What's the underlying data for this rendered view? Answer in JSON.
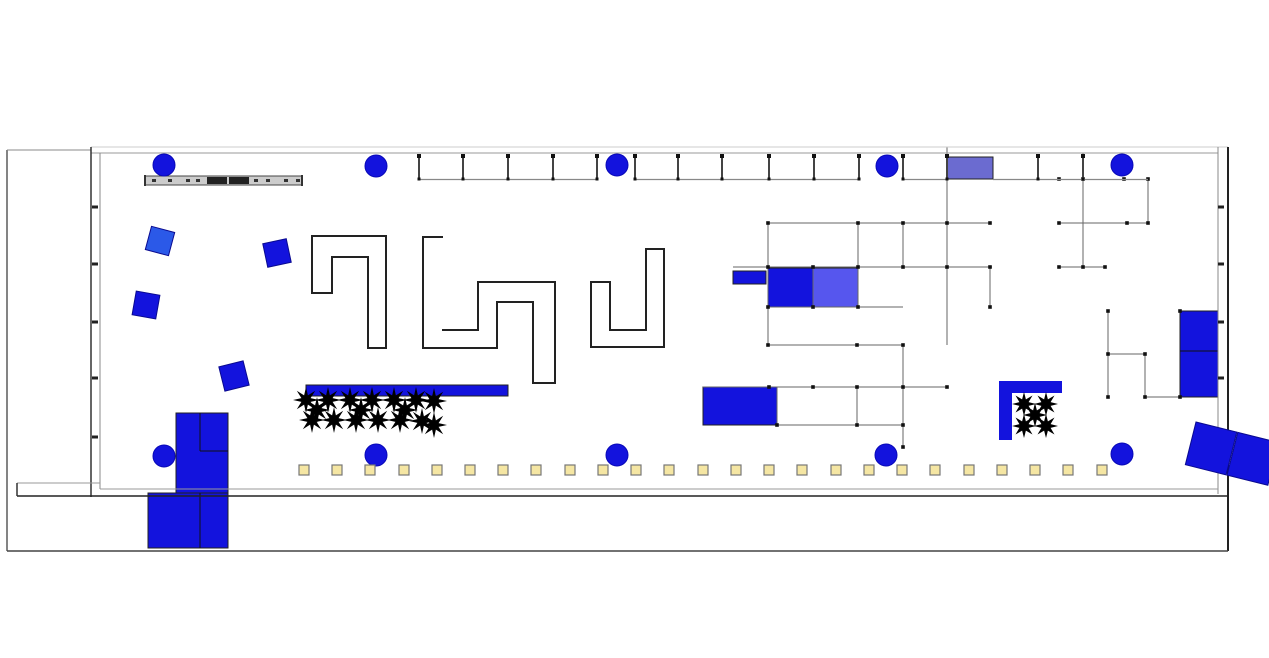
{
  "app": {
    "width": 1269,
    "height": 658,
    "background": "#ffffff",
    "description": "CAD exhibition-hall floor plan"
  },
  "palette": {
    "blue": "#1313dd",
    "blue_light": "#5656ee",
    "purple": "#6b6bd0",
    "blue_alt": "#2b59e8",
    "yellow_fill": "#f5e6a3",
    "yellow_stroke": "#777777",
    "wall_dark": "#222222",
    "wall_mid": "#666666",
    "wall_light": "#999999",
    "gray_bar_fill": "#cccccc",
    "plant": "#000000",
    "node": "#111111"
  },
  "columns": {
    "radius": 11,
    "positions": [
      [
        164,
        165
      ],
      [
        376,
        166
      ],
      [
        617,
        165
      ],
      [
        887,
        166
      ],
      [
        1122,
        165
      ],
      [
        164,
        456
      ],
      [
        376,
        455
      ],
      [
        617,
        455
      ],
      [
        886,
        455
      ],
      [
        1122,
        454
      ]
    ]
  },
  "rotated_squares": [
    {
      "cx": 160,
      "cy": 241,
      "size": 24,
      "angle": 15,
      "color": "#2b59e8"
    },
    {
      "cx": 277,
      "cy": 253,
      "size": 24,
      "angle": -12,
      "color": "#1313dd"
    },
    {
      "cx": 146,
      "cy": 305,
      "size": 24,
      "angle": 10,
      "color": "#1313dd"
    },
    {
      "cx": 234,
      "cy": 376,
      "size": 25,
      "angle": -14,
      "color": "#1313dd"
    }
  ],
  "booths": [
    {
      "x": 306,
      "y": 385,
      "w": 202,
      "h": 11,
      "fill": "#1313dd",
      "name": "platform-bar"
    },
    {
      "x": 733,
      "y": 271,
      "w": 33,
      "h": 13,
      "fill": "#1313dd",
      "name": "booth-small-bar"
    },
    {
      "x": 768,
      "y": 268,
      "w": 45,
      "h": 39,
      "fill": "#1313dd",
      "name": "booth-dark-blue"
    },
    {
      "x": 813,
      "y": 268,
      "w": 45,
      "h": 39,
      "fill": "#5656ee",
      "name": "booth-light-blue"
    },
    {
      "x": 947,
      "y": 157,
      "w": 46,
      "h": 22,
      "fill": "#6b6bd0",
      "name": "booth-purple"
    },
    {
      "x": 703,
      "y": 387,
      "w": 74,
      "h": 38,
      "fill": "#1313dd",
      "name": "booth-lower-blue"
    },
    {
      "x": 1180,
      "y": 311,
      "w": 38,
      "h": 86,
      "fill": "#1313dd",
      "name": "booth-right-double"
    },
    {
      "x": 176,
      "y": 413,
      "w": 52,
      "h": 80,
      "fill": "#1313dd",
      "name": "entrance-block-upper"
    },
    {
      "x": 148,
      "y": 493,
      "w": 80,
      "h": 55,
      "fill": "#1313dd",
      "name": "entrance-block-lower"
    }
  ],
  "booth_inner_lines": [
    [
      200,
      413,
      200,
      451
    ],
    [
      200,
      451,
      228,
      451
    ],
    [
      200,
      493,
      200,
      548
    ],
    [
      1180,
      351,
      1218,
      351
    ]
  ],
  "tilted_pair": {
    "tx": 1196,
    "ty": 422,
    "angle": 14,
    "rects": [
      [
        0,
        0,
        42,
        44
      ],
      [
        43,
        0,
        42,
        44
      ]
    ],
    "fill": "#1313dd"
  },
  "planter": {
    "bars": [
      [
        999,
        381,
        13,
        59
      ],
      [
        999,
        381,
        63,
        12
      ]
    ],
    "fill": "#1313dd"
  },
  "plants": {
    "r_outer": 13,
    "r_inner": 5,
    "small": [
      [
        1024,
        404
      ],
      [
        1046,
        404
      ],
      [
        1024,
        426
      ],
      [
        1046,
        426
      ],
      [
        1035,
        415
      ]
    ],
    "large": [
      [
        306,
        400
      ],
      [
        328,
        400
      ],
      [
        350,
        400
      ],
      [
        372,
        400
      ],
      [
        394,
        400
      ],
      [
        416,
        400
      ],
      [
        434,
        401
      ],
      [
        312,
        420
      ],
      [
        334,
        420
      ],
      [
        356,
        420
      ],
      [
        378,
        420
      ],
      [
        400,
        420
      ],
      [
        422,
        421
      ],
      [
        317,
        410
      ],
      [
        361,
        410
      ],
      [
        405,
        410
      ],
      [
        434,
        425
      ]
    ]
  },
  "walls": [
    [
      7,
      150,
      7,
      551,
      "#333333",
      1.2
    ],
    [
      7,
      150,
      91,
      150,
      "#888888",
      1
    ],
    [
      91,
      147,
      1228,
      147,
      "#cccccc",
      1
    ],
    [
      91,
      153,
      1218,
      153,
      "#999999",
      1
    ],
    [
      91,
      147,
      91,
      497,
      "#333333",
      1.5
    ],
    [
      100,
      153,
      100,
      489,
      "#888888",
      1
    ],
    [
      1218,
      147,
      1218,
      494,
      "#888888",
      1
    ],
    [
      1228,
      147,
      1228,
      551,
      "#222222",
      2
    ],
    [
      100,
      489,
      1218,
      489,
      "#999999",
      1
    ],
    [
      17,
      496,
      1228,
      496,
      "#222222",
      1.5
    ],
    [
      17,
      483,
      100,
      483,
      "#999999",
      1
    ],
    [
      17,
      483,
      17,
      496,
      "#333333",
      1.5
    ],
    [
      7,
      551,
      1228,
      551,
      "#444444",
      1.5
    ]
  ],
  "wall_ticks": [
    [
      95,
      207
    ],
    [
      95,
      264
    ],
    [
      95,
      322
    ],
    [
      95,
      378
    ],
    [
      95,
      437
    ],
    [
      1221,
      207
    ],
    [
      1221,
      264
    ],
    [
      1221,
      322
    ],
    [
      1221,
      378
    ],
    [
      1221,
      437
    ]
  ],
  "maze_walls": [
    {
      "points": [
        [
          312,
          236
        ],
        [
          386,
          236
        ],
        [
          386,
          348
        ],
        [
          368,
          348
        ],
        [
          368,
          257
        ],
        [
          332,
          257
        ],
        [
          332,
          293
        ],
        [
          312,
          293
        ]
      ],
      "closed": true
    },
    {
      "points": [
        [
          443,
          237
        ],
        [
          423,
          237
        ],
        [
          423,
          348
        ],
        [
          497,
          348
        ],
        [
          497,
          302
        ],
        [
          533,
          302
        ],
        [
          533,
          383
        ],
        [
          555,
          383
        ],
        [
          555,
          282
        ],
        [
          478,
          282
        ],
        [
          478,
          330
        ],
        [
          442,
          330
        ]
      ],
      "closed": false
    },
    {
      "points": [
        [
          591,
          282
        ],
        [
          610,
          282
        ],
        [
          610,
          330
        ],
        [
          646,
          330
        ],
        [
          646,
          249
        ],
        [
          664,
          249
        ],
        [
          664,
          347
        ],
        [
          591,
          347
        ]
      ],
      "closed": true
    }
  ],
  "ladder_style": {
    "rail_y": 179.5,
    "tick_top": 155.5
  },
  "ladders": [
    {
      "rail": [
        419,
        597
      ],
      "ticks": [
        419,
        463,
        508,
        553,
        597
      ]
    },
    {
      "rail": [
        635,
        859
      ],
      "ticks": [
        635,
        678,
        722,
        769,
        814,
        859
      ]
    },
    {
      "rail": [
        903,
        947
      ],
      "ticks": [
        903,
        947
      ]
    },
    {
      "rail": [
        993,
        1148
      ],
      "ticks": [
        1038,
        1083
      ]
    }
  ],
  "network": {
    "segments": [
      [
        1083,
        153,
        1083,
        267
      ],
      [
        1148,
        179.5,
        1148,
        223
      ],
      [
        1059,
        223,
        1148,
        223
      ],
      [
        1059,
        267,
        1105,
        267
      ],
      [
        1108,
        311,
        1108,
        397
      ],
      [
        1108,
        354,
        1145,
        354
      ],
      [
        1145,
        354,
        1145,
        397
      ],
      [
        1145,
        397,
        1180,
        397
      ],
      [
        768,
        223,
        990,
        223
      ],
      [
        733,
        267,
        992,
        267
      ],
      [
        768,
        307,
        903,
        307
      ],
      [
        768,
        345,
        903,
        345
      ],
      [
        768,
        223,
        768,
        345
      ],
      [
        813,
        268,
        813,
        307
      ],
      [
        858,
        223,
        858,
        307
      ],
      [
        903,
        223,
        903,
        268
      ],
      [
        947,
        147,
        947,
        345
      ],
      [
        990,
        267,
        990,
        307
      ],
      [
        703,
        387,
        947,
        387
      ],
      [
        777,
        425,
        903,
        425
      ],
      [
        777,
        387,
        777,
        425
      ],
      [
        857,
        387,
        857,
        425
      ],
      [
        903,
        345,
        903,
        447
      ]
    ],
    "nodes": [
      [
        1059,
        179
      ],
      [
        1083,
        179
      ],
      [
        1124,
        179
      ],
      [
        1148,
        179
      ],
      [
        1059,
        223
      ],
      [
        1127,
        223
      ],
      [
        1148,
        223
      ],
      [
        1059,
        267
      ],
      [
        1083,
        267
      ],
      [
        1105,
        267
      ],
      [
        1108,
        311
      ],
      [
        1108,
        354
      ],
      [
        1108,
        397
      ],
      [
        1145,
        354
      ],
      [
        1145,
        397
      ],
      [
        1180,
        311
      ],
      [
        1180,
        397
      ],
      [
        768,
        223
      ],
      [
        858,
        223
      ],
      [
        903,
        223
      ],
      [
        947,
        223
      ],
      [
        990,
        223
      ],
      [
        768,
        267
      ],
      [
        813,
        267
      ],
      [
        858,
        267
      ],
      [
        903,
        267
      ],
      [
        947,
        267
      ],
      [
        990,
        267
      ],
      [
        768,
        307
      ],
      [
        813,
        307
      ],
      [
        858,
        307
      ],
      [
        990,
        307
      ],
      [
        768,
        345
      ],
      [
        857,
        345
      ],
      [
        903,
        345
      ],
      [
        769,
        387
      ],
      [
        813,
        387
      ],
      [
        857,
        387
      ],
      [
        903,
        387
      ],
      [
        947,
        387
      ],
      [
        777,
        425
      ],
      [
        857,
        425
      ],
      [
        903,
        425
      ],
      [
        903,
        447
      ]
    ]
  },
  "yellow_squares": {
    "y": 465,
    "size": 10,
    "xs": [
      299,
      332,
      365,
      399,
      432,
      465,
      498,
      531,
      565,
      598,
      631,
      664,
      698,
      731,
      764,
      797,
      831,
      864,
      897,
      930,
      964,
      997,
      1030,
      1063,
      1097
    ]
  },
  "gray_bar": {
    "x": 145,
    "y": 176,
    "w": 157,
    "h": 9,
    "blocks": [
      [
        207,
        177,
        20,
        7
      ],
      [
        229,
        177,
        20,
        7
      ]
    ],
    "ticks": [
      152,
      168,
      186,
      196,
      254,
      266,
      284,
      296
    ]
  }
}
